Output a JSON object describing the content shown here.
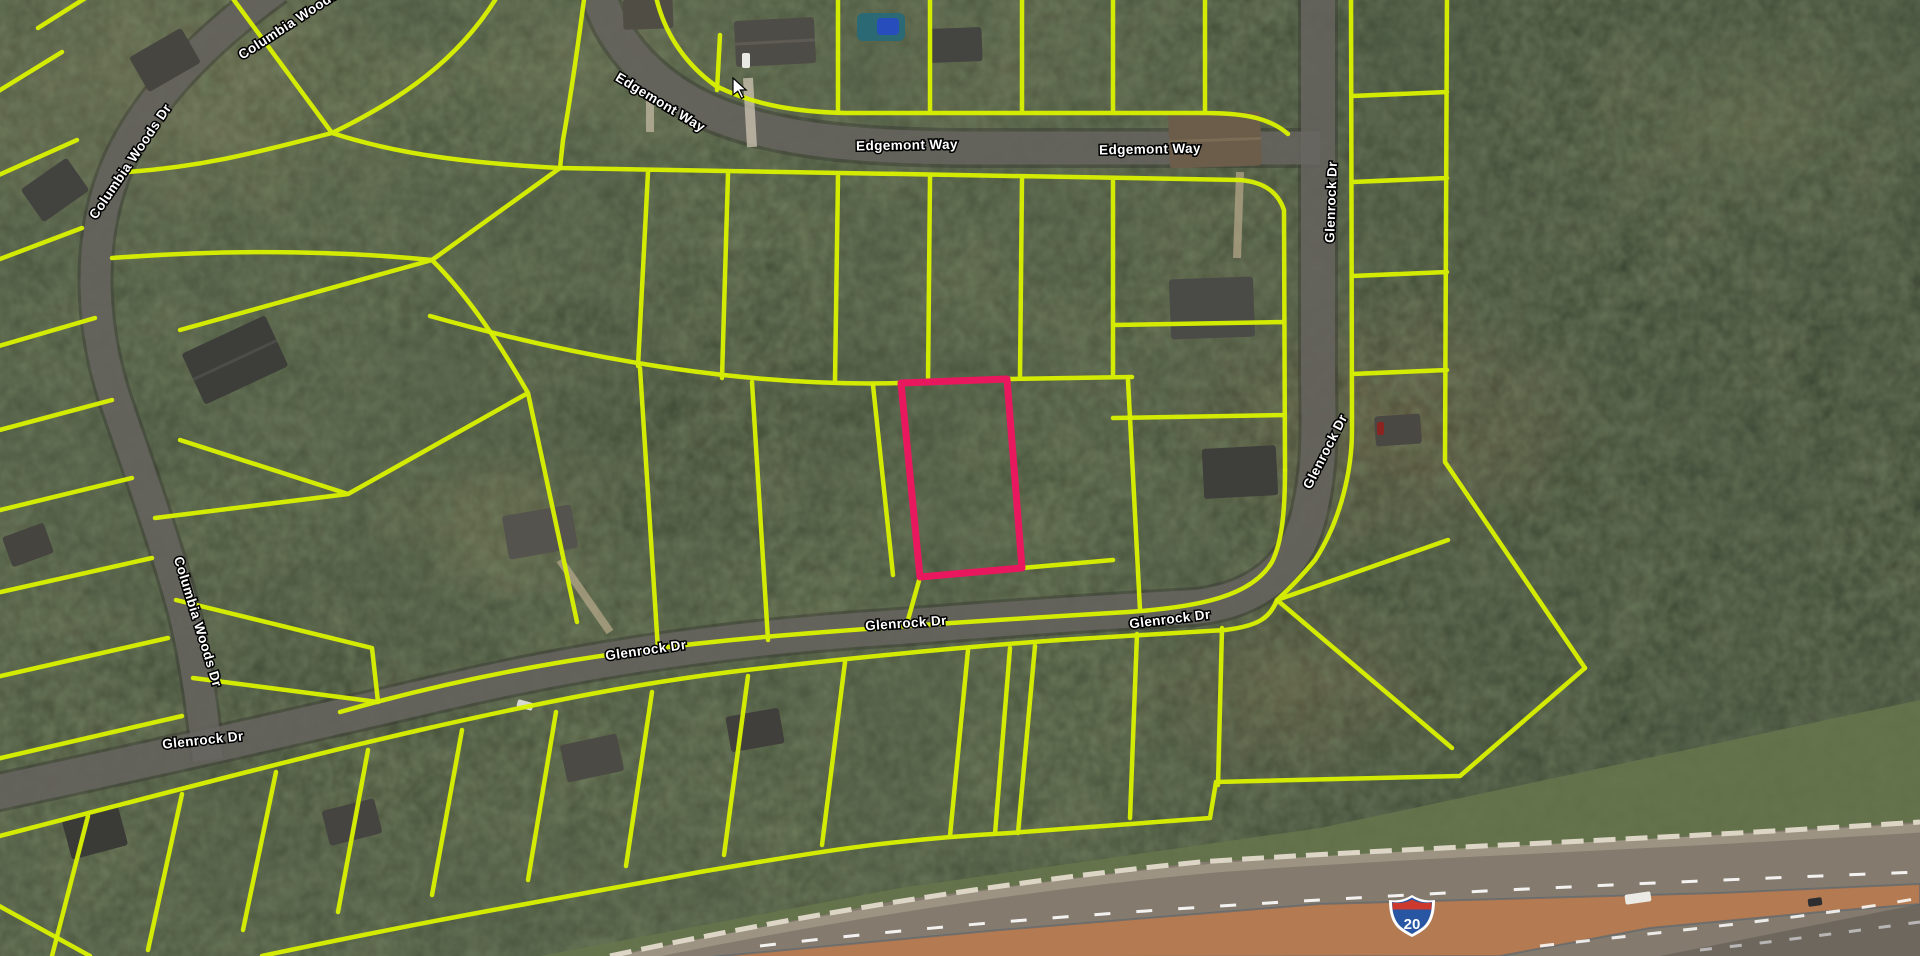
{
  "app": {
    "view_title": "Parcel map satellite view",
    "basemap": "satellite-imagery"
  },
  "colors": {
    "parcel_line": "#d8f000",
    "highlighted_parcel": "#e9185e",
    "road_label_fill": "#ffffff",
    "road_label_halo": "#000000",
    "highway_overlay": "rgba(224,122,58,0.52)",
    "interstate_shield_blue": "#2956a3",
    "interstate_shield_red": "#cc3a2e"
  },
  "map": {
    "streets": [
      "Edgemont Way",
      "Columbia Woods Dr",
      "Glenrock Dr"
    ],
    "street_labels": [
      {
        "text": "Edgemont Way",
        "x": 660,
        "y": 103,
        "rotation": 31
      },
      {
        "text": "Edgemont Way",
        "x": 907,
        "y": 146,
        "rotation": -1
      },
      {
        "text": "Edgemont Way",
        "x": 1150,
        "y": 150,
        "rotation": -1
      },
      {
        "text": "Columbia Woods Dr",
        "x": 297,
        "y": 20,
        "rotation": -33
      },
      {
        "text": "Columbia Woods Dr",
        "x": 131,
        "y": 162,
        "rotation": -56
      },
      {
        "text": "Columbia Woods Dr",
        "x": 197,
        "y": 622,
        "rotation": 73
      },
      {
        "text": "Glenrock Dr",
        "x": 203,
        "y": 741,
        "rotation": -6
      },
      {
        "text": "Glenrock Dr",
        "x": 646,
        "y": 651,
        "rotation": -8
      },
      {
        "text": "Glenrock Dr",
        "x": 906,
        "y": 624,
        "rotation": -4
      },
      {
        "text": "Glenrock Dr",
        "x": 1170,
        "y": 620,
        "rotation": -7
      },
      {
        "text": "Glenrock Dr",
        "x": 1332,
        "y": 202,
        "rotation": -88
      },
      {
        "text": "Glenrock Dr",
        "x": 1326,
        "y": 452,
        "rotation": -63
      }
    ],
    "interstate_shield": {
      "number": "20",
      "x": 1412,
      "y": 914
    },
    "highlighted_parcel": {
      "points": "901,383 1007,379 1022,568 920,577"
    }
  }
}
